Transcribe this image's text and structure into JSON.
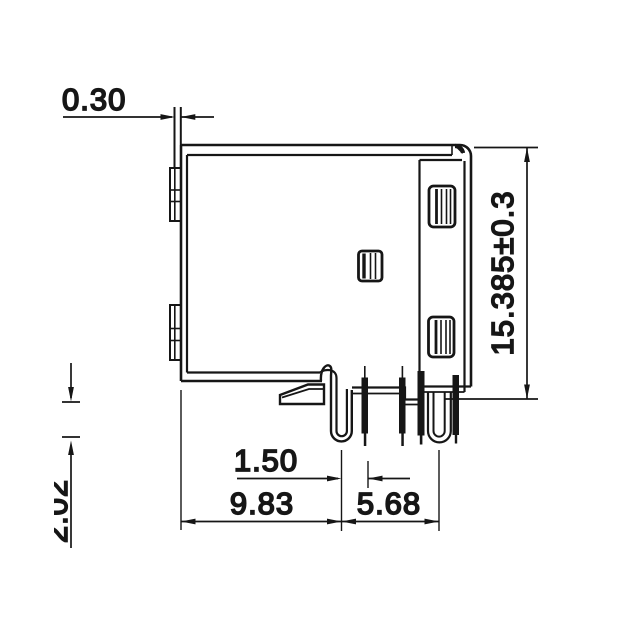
{
  "drawing": {
    "background": "#ffffff",
    "line_color": "#161616",
    "dimensions": {
      "flange_thickness": "0.30",
      "overall_height": "15.385±0.3",
      "pin_pitch": "1.50",
      "left_edge_to_pin1": "9.83",
      "pin1_to_pin_group": "5.68",
      "pin_protrusion_partial": "2.02"
    }
  }
}
